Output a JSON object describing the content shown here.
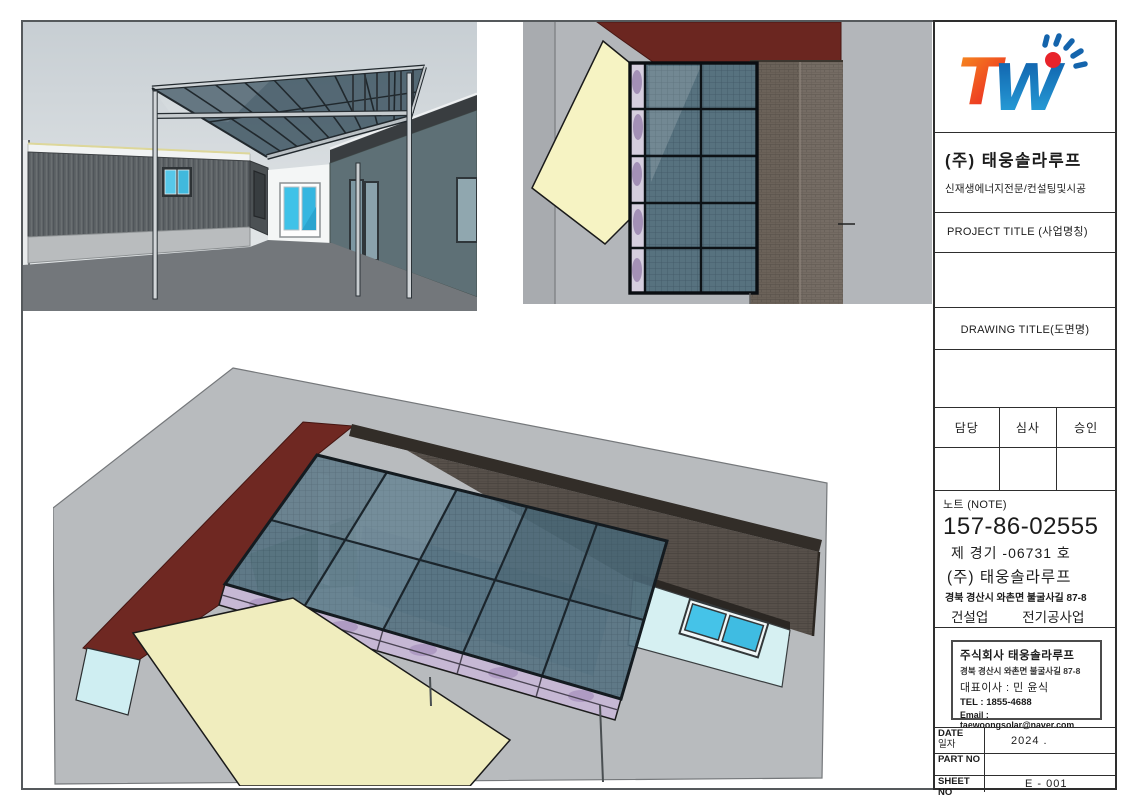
{
  "title_block": {
    "company_name": "(주) 태웅솔라루프",
    "company_subtitle": "신재생에너지전문/컨설팅및시공",
    "project_title_label": "PROJECT TITLE (사업명칭)",
    "project_title_value": "",
    "drawing_title_label": "DRAWING TITLE(도면명)",
    "drawing_title_value": "",
    "approval_columns": {
      "0": "담당",
      "1": "심사",
      "2": "승인"
    },
    "note_label": "노트 (NOTE)",
    "license_number": "157-86-02555",
    "registration_line": "제  경기 -06731  호",
    "note_company": "(주) 태웅솔라루프",
    "note_address": "경북 경산시 와촌면 불굴사길 87-8",
    "business_type_1": "건설업",
    "business_type_2": "전기공사업",
    "info_box": {
      "company": "주식회사  태웅솔라루프",
      "address": "경북 경산시 와촌면 불굴사길 87-8",
      "ceo": "대표이사 : 민 윤식",
      "tel": "TEL : 1855-4688",
      "email": "Email : taewoongsolar@naver.com"
    },
    "footer": {
      "date_label": "DATE",
      "date_label_kr": "일자",
      "date_value": "2024 .",
      "part_label": "PART NO",
      "part_value": "",
      "sheet_label": "SHEET NO",
      "sheet_value": "E - 001"
    }
  },
  "logo": {
    "letter_t": "T",
    "letter_w": "W",
    "colors": {
      "t_top": "#F7941E",
      "t_bottom": "#EA1C24",
      "w_top": "#0E5CA8",
      "w_bottom": "#2BA9E0",
      "dot": "#E8232A",
      "rays": "#1464AC"
    }
  },
  "views": {
    "perspective": "courtyard canopy perspective rendering",
    "top": "solar roof top-down rendering",
    "aerial": "solar canopy aerial rendering"
  },
  "palette": {
    "frame": "#55595c",
    "table_line": "#2e2e2e",
    "sky": "#ccd3d7",
    "ground_dark": "#73777b",
    "ground_light": "#b8bbbe",
    "roof_red": "#6f2822",
    "roof_brown": "#57504a",
    "solar_glass": "#52707f",
    "truss_lavender": "#c6b8d4",
    "accent_yellow": "#f0edbe",
    "wall_cyan": "#d6f0f2",
    "window_cyan": "#45c3e8"
  }
}
